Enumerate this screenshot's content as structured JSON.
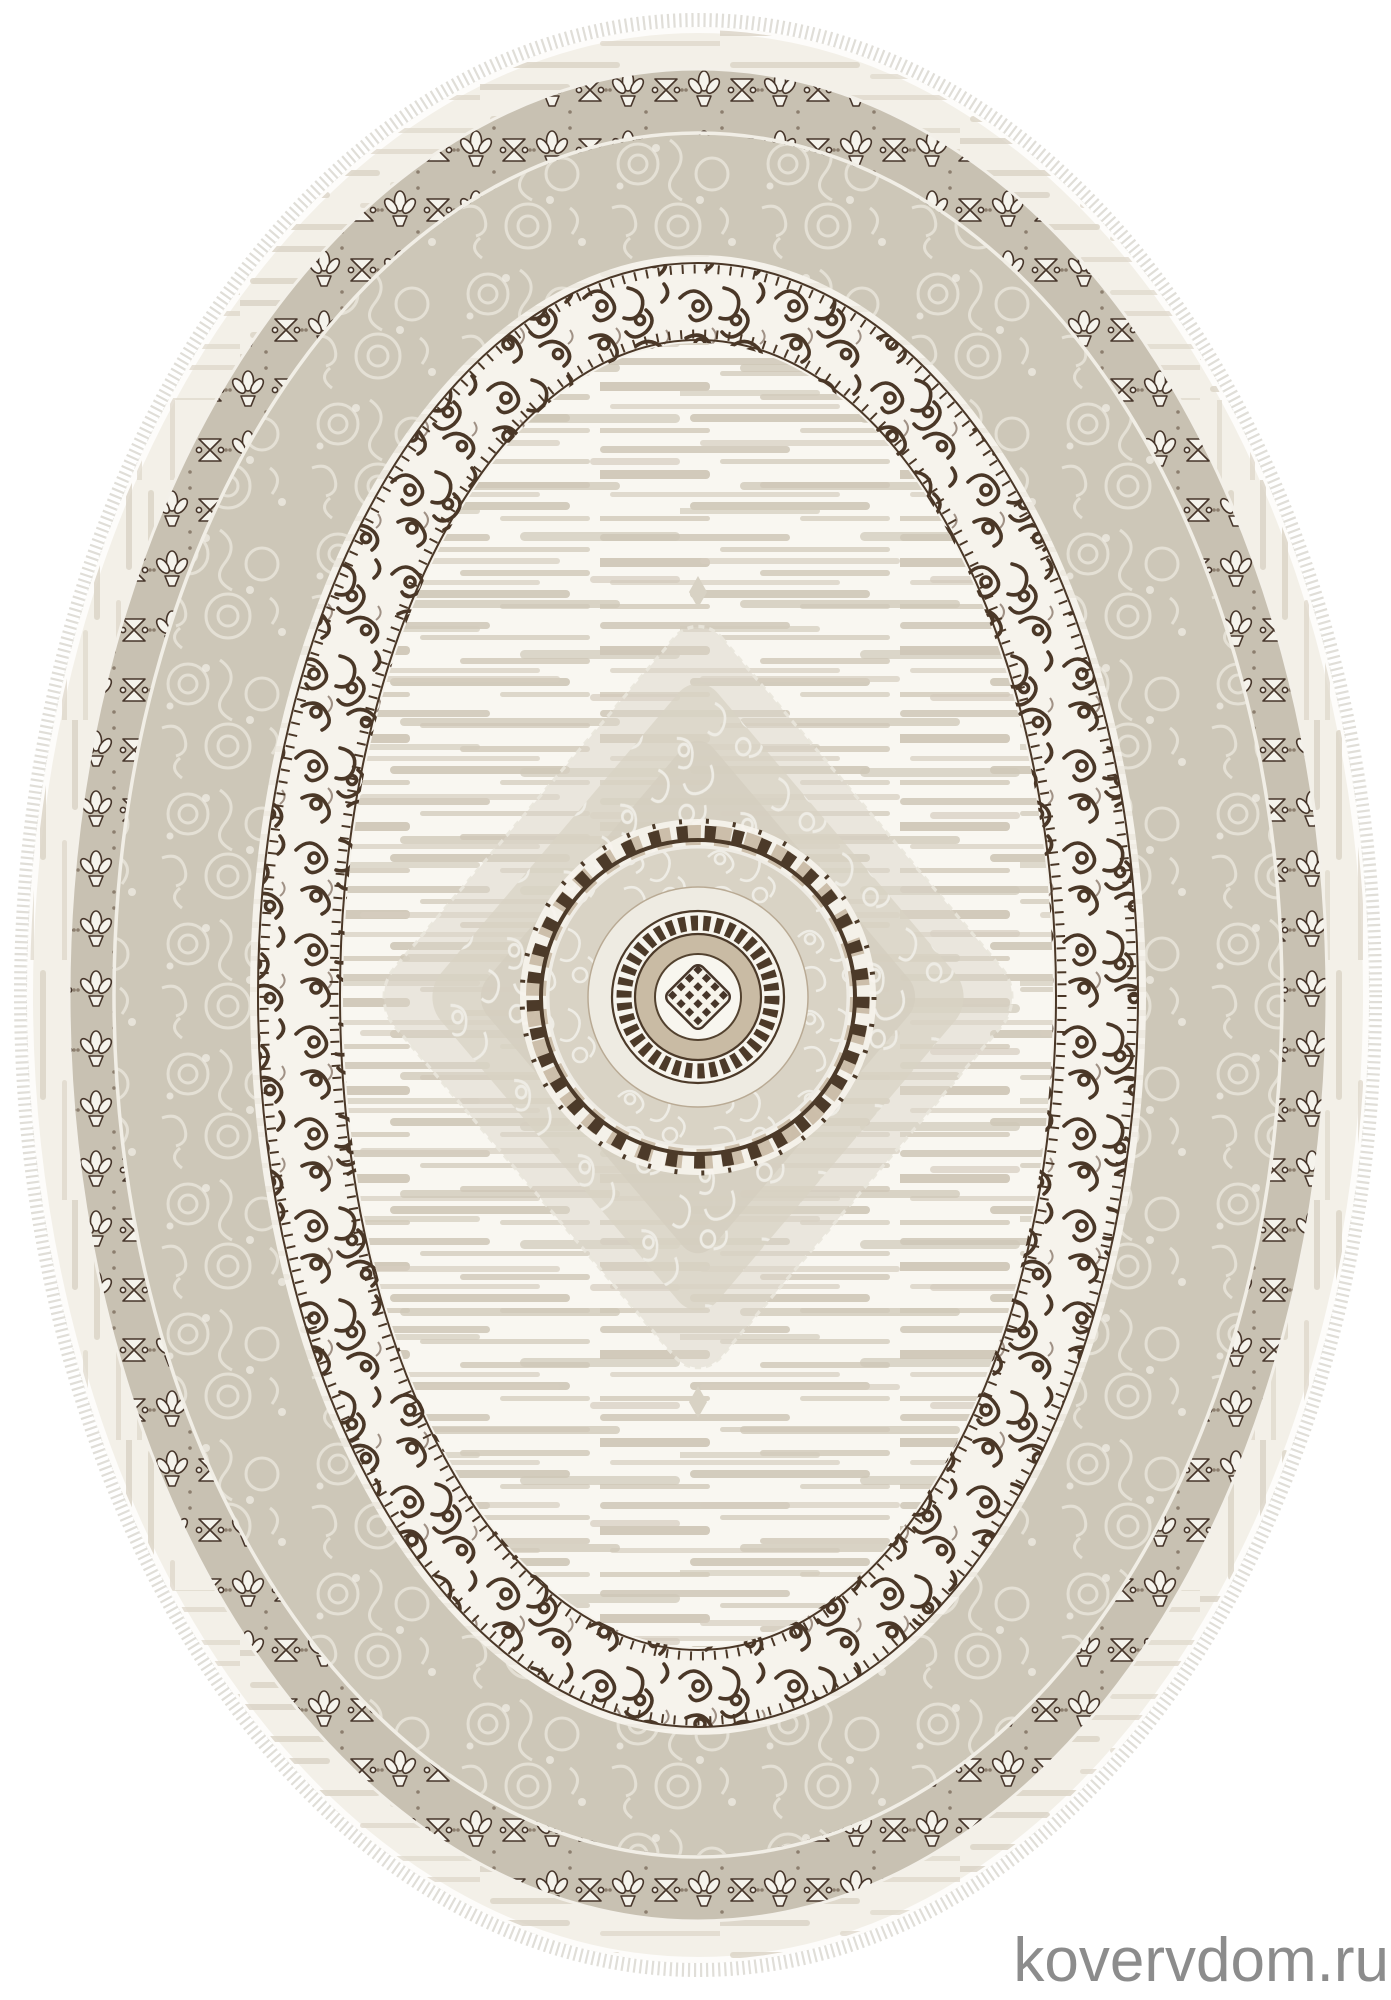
{
  "page": {
    "background_color": "#ffffff",
    "content_type": "product photo of an oval rug"
  },
  "watermark": {
    "text": "kovervdom.ru",
    "color": "#8c8c8c"
  },
  "rug": {
    "shape": "oval",
    "description": "Cream-greige classic oval rug: distressed striped field, round dark-brown center medallion with lattice core, large silver damask diamond, dark-brown scrollwork border ring with zigzag edges, greige damask band, floral guard border with white flowers, streaked outer band and white fringe",
    "colors": {
      "field_cream": "#f8f6f0",
      "stripe_beige": "#d5cec0",
      "band_greige": "#c8c1b2",
      "damask_band": "#cdc7b8",
      "scroll_brown": "#4a3727",
      "medallion_tan": "#c9bba4",
      "motif_white": "#f5f3ec",
      "diamond_silver": "#d8d2c4",
      "fringe_gray": "#dedcd6"
    },
    "parts": [
      "fringe",
      "outer-guard-band",
      "flower-motif-border",
      "damask-border",
      "dark-scroll-border",
      "distressed-field",
      "diamond-medallion",
      "center-circle-medallion"
    ]
  }
}
